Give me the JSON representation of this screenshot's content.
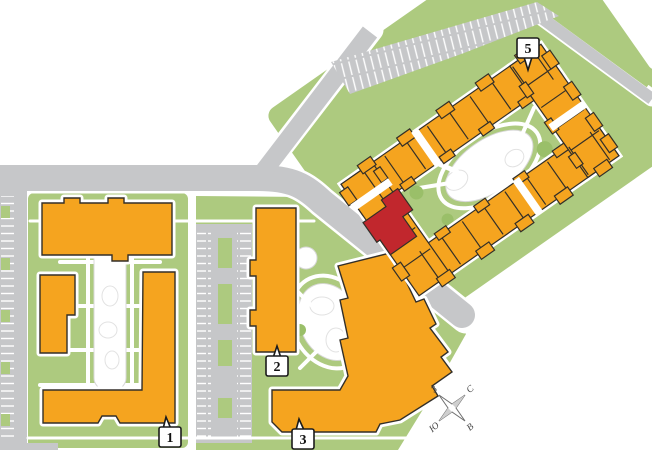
{
  "map": {
    "labels": {
      "b1": "1",
      "b2": "2",
      "b3": "3",
      "b5": "5"
    },
    "compass": {
      "north": "С",
      "east": "В",
      "south": "Ю",
      "west": "З"
    },
    "colors": {
      "building": "#F5A41F",
      "highlight": "#C1272D",
      "green": "#ADCA7F",
      "green_dark": "#9ABF69",
      "road": "#C6C7C9",
      "outline": "#332F28"
    }
  }
}
